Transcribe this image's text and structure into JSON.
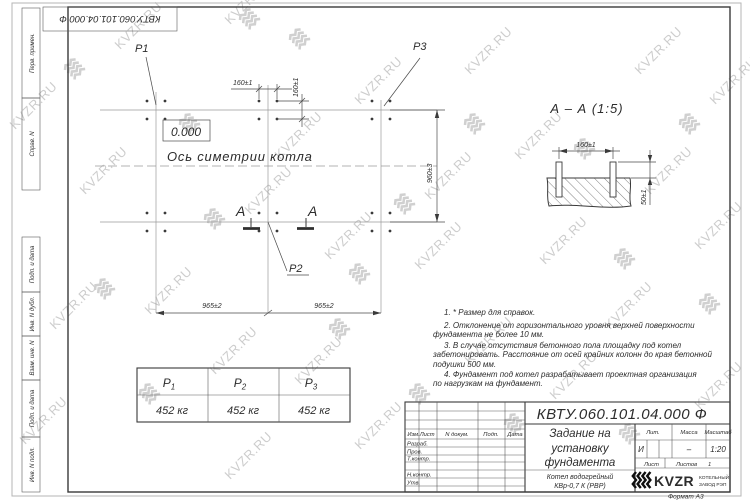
{
  "watermark": {
    "text": "KVZR.RU",
    "color": "#cdcdcd",
    "text_positions": [
      [
        15,
        130
      ],
      [
        120,
        50
      ],
      [
        230,
        25
      ],
      [
        85,
        195
      ],
      [
        55,
        330
      ],
      [
        25,
        445
      ],
      [
        150,
        315
      ],
      [
        215,
        375
      ],
      [
        280,
        160
      ],
      [
        250,
        215
      ],
      [
        330,
        260
      ],
      [
        300,
        385
      ],
      [
        360,
        105
      ],
      [
        430,
        200
      ],
      [
        420,
        270
      ],
      [
        470,
        365
      ],
      [
        520,
        160
      ],
      [
        545,
        265
      ],
      [
        555,
        400
      ],
      [
        470,
        75
      ],
      [
        610,
        330
      ],
      [
        640,
        75
      ],
      [
        650,
        195
      ],
      [
        700,
        250
      ],
      [
        715,
        105
      ],
      [
        700,
        410
      ],
      [
        360,
        450
      ],
      [
        230,
        480
      ]
    ],
    "glyph_positions": [
      [
        65,
        70
      ],
      [
        180,
        125
      ],
      [
        240,
        20
      ],
      [
        290,
        40
      ],
      [
        395,
        205
      ],
      [
        205,
        220
      ],
      [
        350,
        275
      ],
      [
        95,
        290
      ],
      [
        465,
        125
      ],
      [
        575,
        150
      ],
      [
        680,
        125
      ],
      [
        615,
        260
      ],
      [
        140,
        395
      ],
      [
        410,
        395
      ],
      [
        505,
        425
      ],
      [
        620,
        435
      ],
      [
        700,
        305
      ],
      [
        330,
        330
      ]
    ]
  },
  "doc_box": {
    "number": "КВТУ.060.101.04.000  Ф"
  },
  "frame": {
    "left_labels": [
      "Перв. примен.",
      "Справ. N",
      "Подп. и дата",
      "Инв. N дубл.",
      "Взам. инв. N",
      "Подп. и дата",
      "Инв. N подл."
    ]
  },
  "plan": {
    "p1": "P1",
    "p2": "P2",
    "p3": "P3",
    "level": "0.000",
    "axis_label": "Ось симетрии котла",
    "dim_160_h": "160±1",
    "dim_160_v": "160±1",
    "dim_960": "960±3",
    "dim_965_left": "965±2",
    "dim_965_right": "965±2",
    "section_letter_left": "А",
    "section_letter_right": "А"
  },
  "section_view": {
    "title": "А – А (1:5)",
    "dim_160": "160±1",
    "dim_50": "50±1"
  },
  "notes": {
    "lines": [
      "1. * Размер для справок.",
      "2. Отклонение от горизонтального уровня верхней поверхности",
      "фундамента не более 10 мм.",
      "3. В случае отсутствия бетонного пола площадку под котел",
      "забетонировать. Расстояние от осей крайних колонн до края бетонной",
      "подушки 500 мм.",
      "4. Фундамент под котел разрабатывает проектная организация",
      "по нагрузкам на фундамент."
    ]
  },
  "load_table": {
    "letter": "P",
    "headers": [
      {
        "sub": "1"
      },
      {
        "sub": "2"
      },
      {
        "sub": "3"
      }
    ],
    "values": [
      "452 кг",
      "452 кг",
      "452 кг"
    ]
  },
  "title_block": {
    "doc_number": "КВТУ.060.101.04.000  Ф",
    "title_lines": [
      "Задание на",
      "установку",
      "фундамента"
    ],
    "product_lines": [
      "Котел водогрейный",
      "КВр-0,7 К (РВР)"
    ],
    "header_cols": {
      "izm": "Изм.Лист",
      "doc": "N докум.",
      "podp": "Подп.",
      "data": "Дата"
    },
    "row_labels": [
      "Разраб.",
      "Пров.",
      "Т.контр.",
      "Н.контр.",
      "Утв."
    ],
    "lit": {
      "label": "Лит.",
      "value": "И"
    },
    "mass": {
      "label": "Масса",
      "value": "–"
    },
    "scale": {
      "label": "Масштаб",
      "value": "1:20"
    },
    "sheet": {
      "label": "Лист"
    },
    "sheets": {
      "label": "Листов",
      "value": "1"
    },
    "company": {
      "name": "KVZR",
      "line1": "КОТЕЛЬНЫЙ",
      "line2": "ЗАВОД РЭП"
    },
    "format": "Формат А3"
  }
}
